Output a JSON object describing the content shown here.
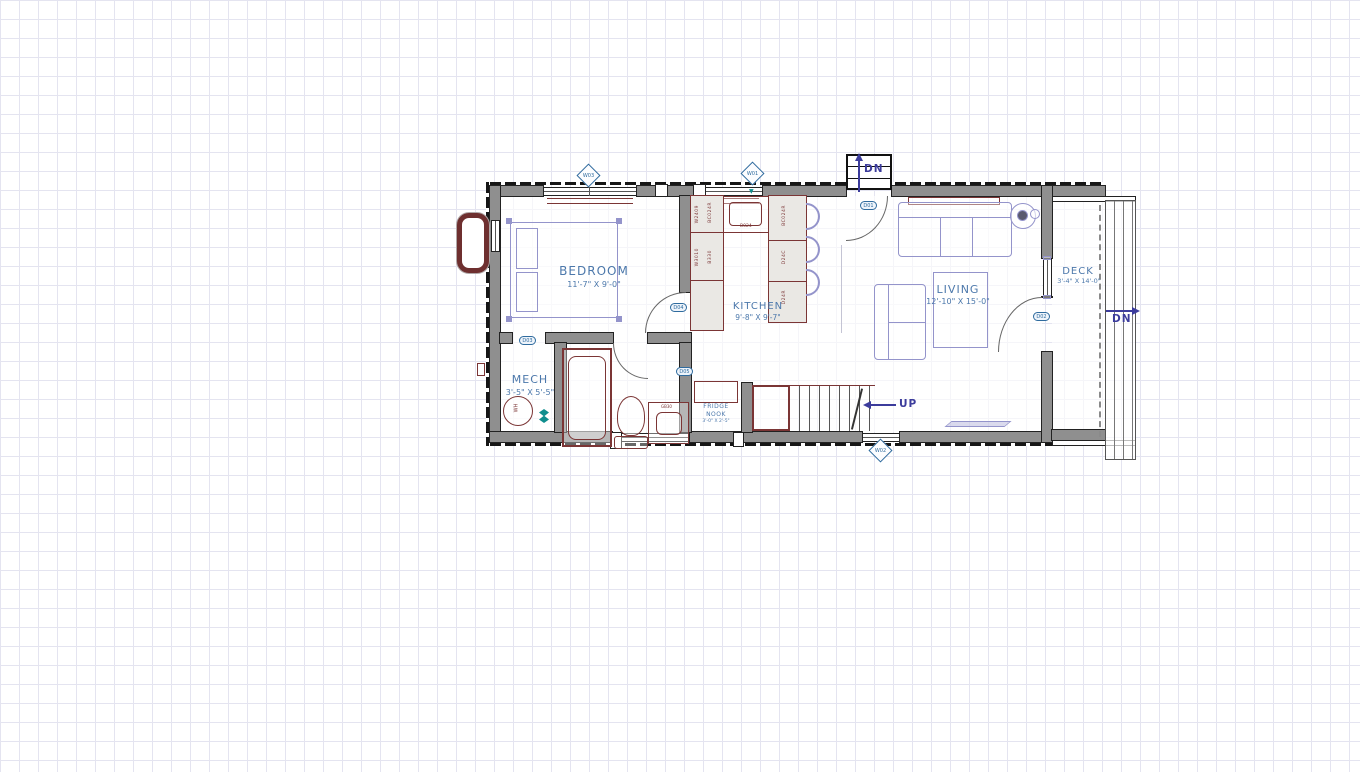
{
  "canvas": {
    "grid_color": "#e4e4f0",
    "background": "#ffffff"
  },
  "colors": {
    "wall_gray": "#8f8f8f",
    "accent_red": "#7b3535",
    "furniture_purple": "#9494cb",
    "label_blue": "#4c78ab",
    "nav_indigo": "#3c3c9c",
    "callout_blue": "#2f6b9e",
    "teal": "#0f8e8e"
  },
  "rooms": {
    "bedroom": {
      "name": "BEDROOM",
      "dims": "11'-7\" X 9'-0\""
    },
    "kitchen": {
      "name": "KITCHEN",
      "dims": "9'-8\" X 9'-7\""
    },
    "living": {
      "name": "LIVING",
      "dims": "12'-10\" X 15'-0\""
    },
    "deck": {
      "name": "DECK",
      "dims": "3'-4\" X 14'-0\""
    },
    "mech": {
      "name": "MECH",
      "dims": "3'-5\" X 5'-5\""
    },
    "fridge_nook": {
      "line1": "FRIDGE",
      "line2": "NOOK",
      "dims": "3'-0\" X 2'-5\""
    }
  },
  "stairs": {
    "up": "UP",
    "entry_down": "DN",
    "deck_down": "DN"
  },
  "callouts": {
    "window_tags": [
      {
        "id": "W03"
      },
      {
        "id": "W01"
      },
      {
        "id": "W02"
      }
    ],
    "door_tags": [
      {
        "id": "D01"
      },
      {
        "id": "D02"
      },
      {
        "id": "D03"
      },
      {
        "id": "D04"
      },
      {
        "id": "D05"
      }
    ]
  },
  "fixtures": {
    "water_heater": "WH",
    "vanity": "GB30",
    "sink": "B024"
  },
  "cabinets": {
    "left_run": [
      "W2409",
      "BC024R",
      "W3010",
      "B330"
    ],
    "peninsula": [
      "BC024R",
      "D24C",
      "D24R"
    ]
  }
}
